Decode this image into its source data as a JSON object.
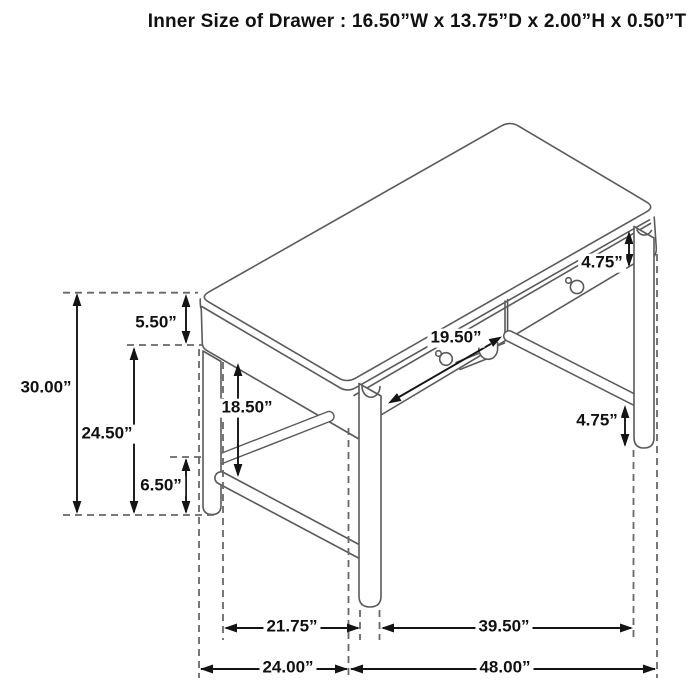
{
  "title": "Inner Size of Drawer : 16.50”W x 13.75”D x 2.00”H x 0.50”T",
  "labels": {
    "overall_height": "30.00”",
    "floor_to_apron_bottom": "24.50”",
    "top_and_apron_thickness": "5.50”",
    "stretcher_height": "6.50”",
    "knee_clearance": "18.50”",
    "apron_depth_right": "4.75”",
    "stretcher_to_floor_right": "4.75”",
    "drawer_opening_width": "19.50”",
    "side_leg_span": "21.75”",
    "top_depth": "24.00”",
    "front_leg_span": "39.50”",
    "top_width": "48.00”"
  },
  "colors": {
    "line_gray": "#5a5a5a",
    "dash_gray": "#686868",
    "dim_black": "#141414",
    "background": "#ffffff"
  }
}
